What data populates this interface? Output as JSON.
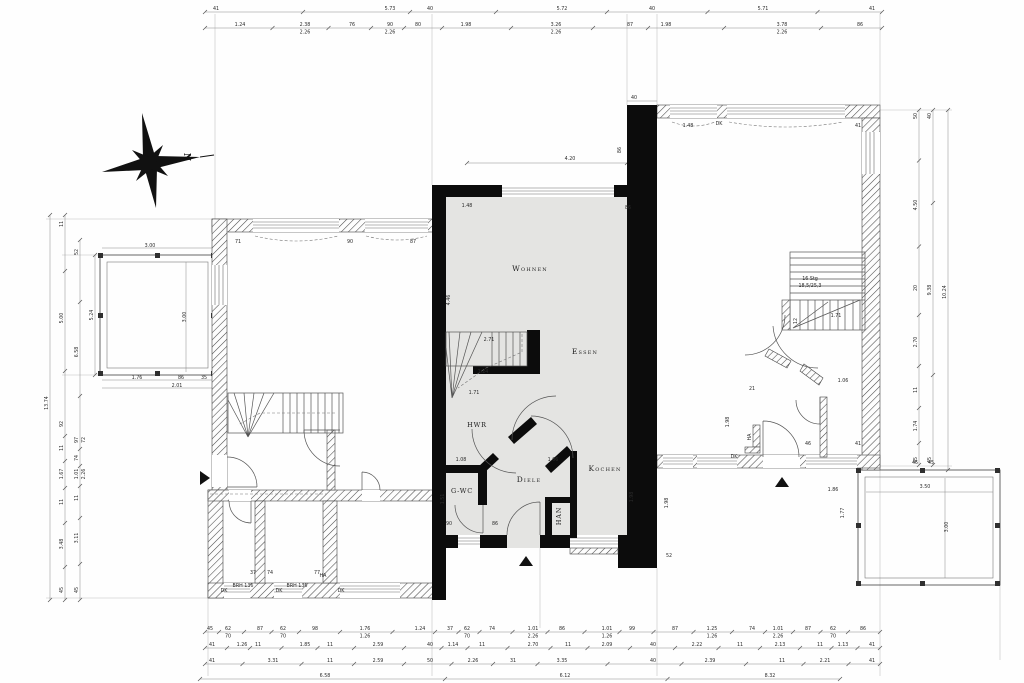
{
  "rooms": {
    "wohnen": "Wohnen",
    "essen": "Essen",
    "hwr": "HWR",
    "diele": "Diele",
    "kochen": "Kochen",
    "gwc": "G-WC",
    "han": "HAN"
  },
  "compass": {
    "north_label": "N"
  },
  "colors": {
    "background": "#ffffff",
    "unit_fill": "#e4e4e2",
    "wall": "#0c0c0c",
    "line": "#555555",
    "text": "#2b2b2b"
  },
  "dim_strips": [
    {
      "dir": "h",
      "line": 12,
      "from": 205,
      "to": 882,
      "labels": [
        {
          "p": 216,
          "t": "41"
        },
        {
          "p": 390,
          "t": "5.73"
        },
        {
          "p": 430,
          "t": "40"
        },
        {
          "p": 562,
          "t": "5.72"
        },
        {
          "p": 652,
          "t": "40"
        },
        {
          "p": 763,
          "t": "5.71"
        },
        {
          "p": 872,
          "t": "41"
        }
      ]
    },
    {
      "dir": "h",
      "line": 28,
      "from": 205,
      "to": 882,
      "labels": [
        {
          "p": 240,
          "t": "1.24"
        },
        {
          "p": 305,
          "t": "2.38",
          "t2": "2.26"
        },
        {
          "p": 352,
          "t": "76"
        },
        {
          "p": 390,
          "t": "90",
          "t2": "2.26"
        },
        {
          "p": 418,
          "t": "80"
        },
        {
          "p": 466,
          "t": "1.98"
        },
        {
          "p": 556,
          "t": "3.26",
          "t2": "2.26"
        },
        {
          "p": 630,
          "t": "87"
        },
        {
          "p": 666,
          "t": "1.98"
        },
        {
          "p": 782,
          "t": "3.78",
          "t2": "2.26"
        },
        {
          "p": 860,
          "t": "86"
        }
      ]
    },
    {
      "dir": "h",
      "line": 632,
      "from": 205,
      "to": 880,
      "labels": [
        {
          "p": 210,
          "t": "45"
        },
        {
          "p": 228,
          "t": "62",
          "t2": "70"
        },
        {
          "p": 260,
          "t": "87"
        },
        {
          "p": 283,
          "t": "62",
          "t2": "70"
        },
        {
          "p": 315,
          "t": "98"
        },
        {
          "p": 365,
          "t": "1.76",
          "t2": "1.26"
        },
        {
          "p": 420,
          "t": "1.24"
        },
        {
          "p": 450,
          "t": "37"
        },
        {
          "p": 467,
          "t": "62",
          "t2": "70"
        },
        {
          "p": 492,
          "t": "74"
        },
        {
          "p": 533,
          "t": "1.01",
          "t2": "2.26"
        },
        {
          "p": 562,
          "t": "86"
        },
        {
          "p": 607,
          "t": "1.01",
          "t2": "1.26"
        },
        {
          "p": 632,
          "t": "99"
        },
        {
          "p": 675,
          "t": "87"
        },
        {
          "p": 712,
          "t": "1.25",
          "t2": "1.26"
        },
        {
          "p": 752,
          "t": "74"
        },
        {
          "p": 778,
          "t": "1.01",
          "t2": "2.26"
        },
        {
          "p": 808,
          "t": "87"
        },
        {
          "p": 833,
          "t": "62",
          "t2": "70"
        },
        {
          "p": 863,
          "t": "86"
        }
      ]
    },
    {
      "dir": "h",
      "line": 648,
      "from": 205,
      "to": 880,
      "labels": [
        {
          "p": 212,
          "t": "41"
        },
        {
          "p": 242,
          "t": "1.26"
        },
        {
          "p": 258,
          "t": "11"
        },
        {
          "p": 305,
          "t": "1.85"
        },
        {
          "p": 330,
          "t": "11"
        },
        {
          "p": 378,
          "t": "2.59"
        },
        {
          "p": 430,
          "t": "40"
        },
        {
          "p": 453,
          "t": "1.14"
        },
        {
          "p": 482,
          "t": "11"
        },
        {
          "p": 533,
          "t": "2.70"
        },
        {
          "p": 568,
          "t": "11"
        },
        {
          "p": 607,
          "t": "2.09"
        },
        {
          "p": 653,
          "t": "40"
        },
        {
          "p": 697,
          "t": "2.22"
        },
        {
          "p": 740,
          "t": "11"
        },
        {
          "p": 780,
          "t": "2.13"
        },
        {
          "p": 820,
          "t": "11"
        },
        {
          "p": 843,
          "t": "1.13"
        },
        {
          "p": 872,
          "t": "41"
        }
      ]
    },
    {
      "dir": "h",
      "line": 664,
      "from": 205,
      "to": 880,
      "labels": [
        {
          "p": 212,
          "t": "41"
        },
        {
          "p": 273,
          "t": "3.31"
        },
        {
          "p": 330,
          "t": "11"
        },
        {
          "p": 378,
          "t": "2.59"
        },
        {
          "p": 430,
          "t": "50"
        },
        {
          "p": 473,
          "t": "2.26"
        },
        {
          "p": 513,
          "t": "31"
        },
        {
          "p": 562,
          "t": "3.35"
        },
        {
          "p": 653,
          "t": "40"
        },
        {
          "p": 710,
          "t": "2.39"
        },
        {
          "p": 782,
          "t": "11"
        },
        {
          "p": 825,
          "t": "2.21"
        },
        {
          "p": 872,
          "t": "41"
        }
      ]
    },
    {
      "dir": "h",
      "line": 679,
      "from": 200,
      "to": 840,
      "labels": [
        {
          "p": 325,
          "t": "6.58"
        },
        {
          "p": 565,
          "t": "6.12"
        },
        {
          "p": 770,
          "t": "8.32"
        }
      ]
    },
    {
      "dir": "v",
      "line": 50,
      "from": 215,
      "to": 600,
      "labels": [
        {
          "p": 403,
          "t": "13.74"
        }
      ]
    },
    {
      "dir": "v",
      "line": 65,
      "from": 215,
      "to": 600,
      "labels": [
        {
          "p": 224,
          "t": "11"
        },
        {
          "p": 318,
          "t": "5.00"
        },
        {
          "p": 424,
          "t": "92"
        },
        {
          "p": 448,
          "t": "11"
        },
        {
          "p": 474,
          "t": "1.67"
        },
        {
          "p": 502,
          "t": "11"
        },
        {
          "p": 544,
          "t": "3.48"
        },
        {
          "p": 590,
          "t": "45"
        }
      ]
    },
    {
      "dir": "v",
      "line": 80,
      "from": 240,
      "to": 600,
      "labels": [
        {
          "p": 252,
          "t": "52"
        },
        {
          "p": 352,
          "t": "6.58"
        },
        {
          "p": 440,
          "t": "97",
          "t2": "72"
        },
        {
          "p": 458,
          "t": "74"
        },
        {
          "p": 474,
          "t": "1.01",
          "t2": "2.26"
        },
        {
          "p": 498,
          "t": "11"
        },
        {
          "p": 538,
          "t": "3.11"
        },
        {
          "p": 590,
          "t": "45"
        }
      ]
    },
    {
      "dir": "v",
      "line": 95,
      "from": 255,
      "to": 375,
      "labels": [
        {
          "p": 315,
          "t": "5.24"
        }
      ]
    },
    {
      "dir": "v",
      "line": 919,
      "from": 110,
      "to": 465,
      "labels": [
        {
          "p": 116,
          "t": "50"
        },
        {
          "p": 205,
          "t": "4.50"
        },
        {
          "p": 288,
          "t": "20"
        },
        {
          "p": 342,
          "t": "2.70"
        },
        {
          "p": 390,
          "t": "11"
        },
        {
          "p": 426,
          "t": "1.74"
        },
        {
          "p": 460,
          "t": "45"
        }
      ]
    },
    {
      "dir": "v",
      "line": 933,
      "from": 110,
      "to": 465,
      "labels": [
        {
          "p": 116,
          "t": "40"
        },
        {
          "p": 290,
          "t": "9.38"
        },
        {
          "p": 460,
          "t": "45"
        }
      ]
    },
    {
      "dir": "v",
      "line": 948,
      "from": 110,
      "to": 470,
      "labels": [
        {
          "p": 292,
          "t": "10.24"
        }
      ]
    }
  ],
  "free_labels": [
    {
      "x": 570,
      "y": 160,
      "t": "4.20"
    },
    {
      "x": 467,
      "y": 207,
      "t": "1.48"
    },
    {
      "x": 628,
      "y": 209,
      "t": "86"
    },
    {
      "x": 450,
      "y": 300,
      "t": "4.46",
      "r": -90
    },
    {
      "x": 489,
      "y": 341,
      "t": "2.71"
    },
    {
      "x": 483,
      "y": 373,
      "t": "1.24"
    },
    {
      "x": 474,
      "y": 394,
      "t": "1.71"
    },
    {
      "x": 461,
      "y": 461,
      "t": "1.08"
    },
    {
      "x": 553,
      "y": 461,
      "t": "1.06"
    },
    {
      "x": 633,
      "y": 497,
      "t": "1.98",
      "r": -90
    },
    {
      "x": 668,
      "y": 503,
      "t": "1.98",
      "r": -90
    },
    {
      "x": 444,
      "y": 499,
      "t": "1.51",
      "r": -90
    },
    {
      "x": 449,
      "y": 525,
      "t": "90"
    },
    {
      "x": 495,
      "y": 525,
      "t": "86"
    },
    {
      "x": 669,
      "y": 557,
      "t": "52"
    },
    {
      "x": 634,
      "y": 99,
      "t": "40"
    },
    {
      "x": 621,
      "y": 150,
      "t": "86",
      "r": -90
    },
    {
      "x": 688,
      "y": 127,
      "t": "1.48"
    },
    {
      "x": 719,
      "y": 125,
      "t": "DK",
      "n": "window-label"
    },
    {
      "x": 858,
      "y": 127,
      "t": "41"
    },
    {
      "x": 797,
      "y": 321,
      "t": "12",
      "r": -90
    },
    {
      "x": 836,
      "y": 317,
      "t": "1.71"
    },
    {
      "x": 843,
      "y": 382,
      "t": "1.06"
    },
    {
      "x": 752,
      "y": 390,
      "t": "21"
    },
    {
      "x": 810,
      "y": 280,
      "t": "16 Stg",
      "n": "stair-label"
    },
    {
      "x": 810,
      "y": 287,
      "t": "18,5/25,3",
      "n": "stair-label"
    },
    {
      "x": 751,
      "y": 437,
      "t": "HA",
      "r": -90,
      "n": "niche-label"
    },
    {
      "x": 729,
      "y": 422,
      "t": "1.98",
      "r": -90
    },
    {
      "x": 808,
      "y": 445,
      "t": "46"
    },
    {
      "x": 858,
      "y": 445,
      "t": "41"
    },
    {
      "x": 833,
      "y": 491,
      "t": "1.86"
    },
    {
      "x": 844,
      "y": 513,
      "t": "1.77",
      "r": -90
    },
    {
      "x": 238,
      "y": 243,
      "t": "71"
    },
    {
      "x": 350,
      "y": 243,
      "t": "90"
    },
    {
      "x": 413,
      "y": 243,
      "t": "87"
    },
    {
      "x": 323,
      "y": 577,
      "t": "HA",
      "n": "niche-label"
    },
    {
      "x": 253,
      "y": 574,
      "t": "37"
    },
    {
      "x": 270,
      "y": 574,
      "t": "74"
    },
    {
      "x": 317,
      "y": 574,
      "t": "77"
    },
    {
      "x": 224,
      "y": 592,
      "t": "DK",
      "n": "window-label"
    },
    {
      "x": 243,
      "y": 587,
      "t": "BRH 136",
      "n": "window-label"
    },
    {
      "x": 279,
      "y": 592,
      "t": "DK",
      "n": "window-label"
    },
    {
      "x": 297,
      "y": 587,
      "t": "BRH 136",
      "n": "window-label"
    },
    {
      "x": 341,
      "y": 592,
      "t": "DK",
      "n": "window-label"
    },
    {
      "x": 734,
      "y": 458,
      "t": "DK",
      "n": "window-label"
    },
    {
      "x": 150,
      "y": 247,
      "t": "3.00"
    },
    {
      "x": 186,
      "y": 317,
      "t": "3.00",
      "r": -90
    },
    {
      "x": 137,
      "y": 379,
      "t": "1.76"
    },
    {
      "x": 181,
      "y": 379,
      "t": "86"
    },
    {
      "x": 204,
      "y": 379,
      "t": "35"
    },
    {
      "x": 177,
      "y": 387,
      "t": "2.01"
    },
    {
      "x": 925,
      "y": 488,
      "t": "3.50"
    },
    {
      "x": 948,
      "y": 527,
      "t": "3.00",
      "r": -90
    },
    {
      "x": 915,
      "y": 464,
      "t": "45"
    },
    {
      "x": 931,
      "y": 464,
      "t": "45"
    }
  ]
}
